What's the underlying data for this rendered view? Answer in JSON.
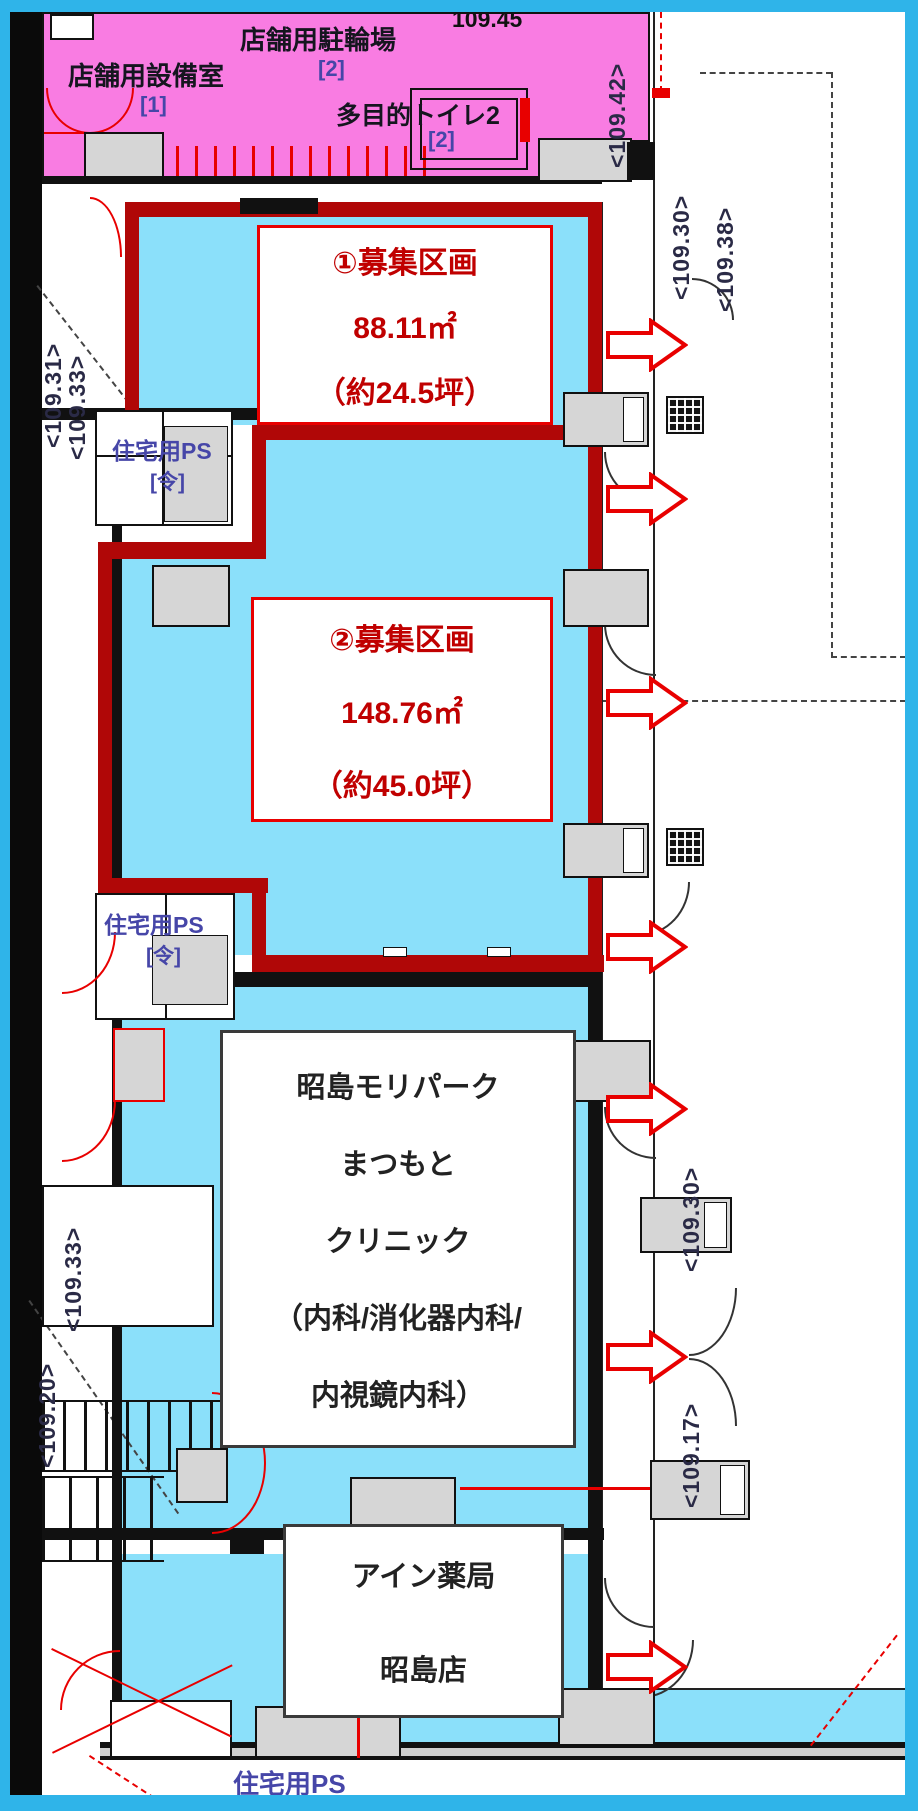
{
  "colors": {
    "frame": "#2FB4E9",
    "pink": "#F97CE2",
    "cyan": "#8BE0FA",
    "dark_red": "#B00707",
    "red": "#E80000",
    "red_text": "#C00000",
    "gray": "#D6D6D6",
    "ink": "#15151F",
    "label_blue": "#4646A8",
    "elev_text": "#2A2A46"
  },
  "top_zone": {
    "bicycle_parking": {
      "label": "店舗用駐輪場",
      "num": "[2]"
    },
    "equipment_room": {
      "label": "店舗用設備室",
      "num": "[1]"
    },
    "toilet": {
      "label": "多目的トイレ2",
      "num": "[2]"
    },
    "elevation": "109.45"
  },
  "units": {
    "unit1": {
      "lines": [
        "①募集区画",
        "88.11㎡",
        "（約24.5坪）"
      ]
    },
    "unit2": {
      "lines": [
        "②募集区画",
        "148.76㎡",
        "（約45.0坪）"
      ]
    },
    "clinic": {
      "lines": [
        "昭島モリパーク",
        "まつもと",
        "クリニック",
        "（内科/消化器内科/",
        "内視鏡内科）"
      ]
    },
    "pharmacy": {
      "lines": [
        "アイン薬局",
        "昭島店"
      ]
    }
  },
  "ps": {
    "label": "住宅用PS",
    "num": "[令]"
  },
  "elevations": {
    "right_top": [
      "<109.42>",
      "<109.30>",
      "<109.38>"
    ],
    "left_top": [
      "<109.31>",
      "<109.33>"
    ],
    "left_mid": "<109.33>",
    "left_bottom": "<109.20>",
    "right_bottom": [
      "<109.30>",
      "<109.17>"
    ]
  }
}
